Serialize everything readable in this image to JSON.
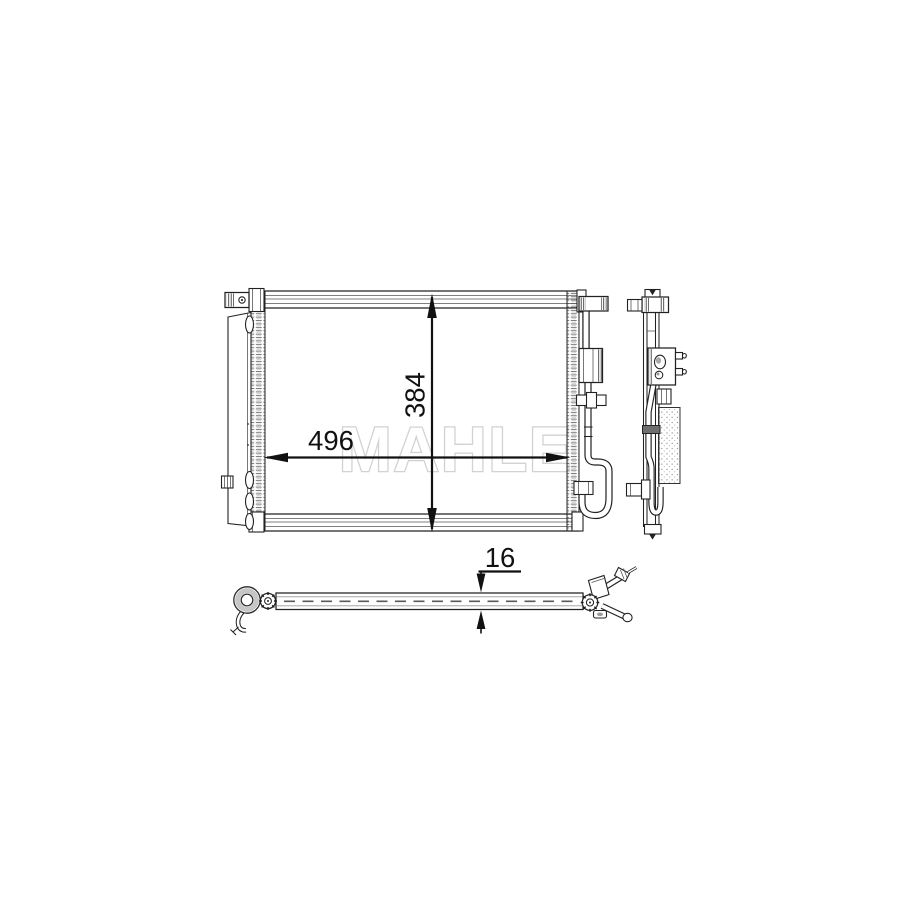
{
  "watermark": {
    "text": "MAHLE",
    "color": "#d2d2d2"
  },
  "dimensions": {
    "width_label": "496",
    "height_label": "384",
    "depth_label": "16"
  },
  "colors": {
    "line": "#222222",
    "dimension": "#111111",
    "background": "#ffffff"
  }
}
